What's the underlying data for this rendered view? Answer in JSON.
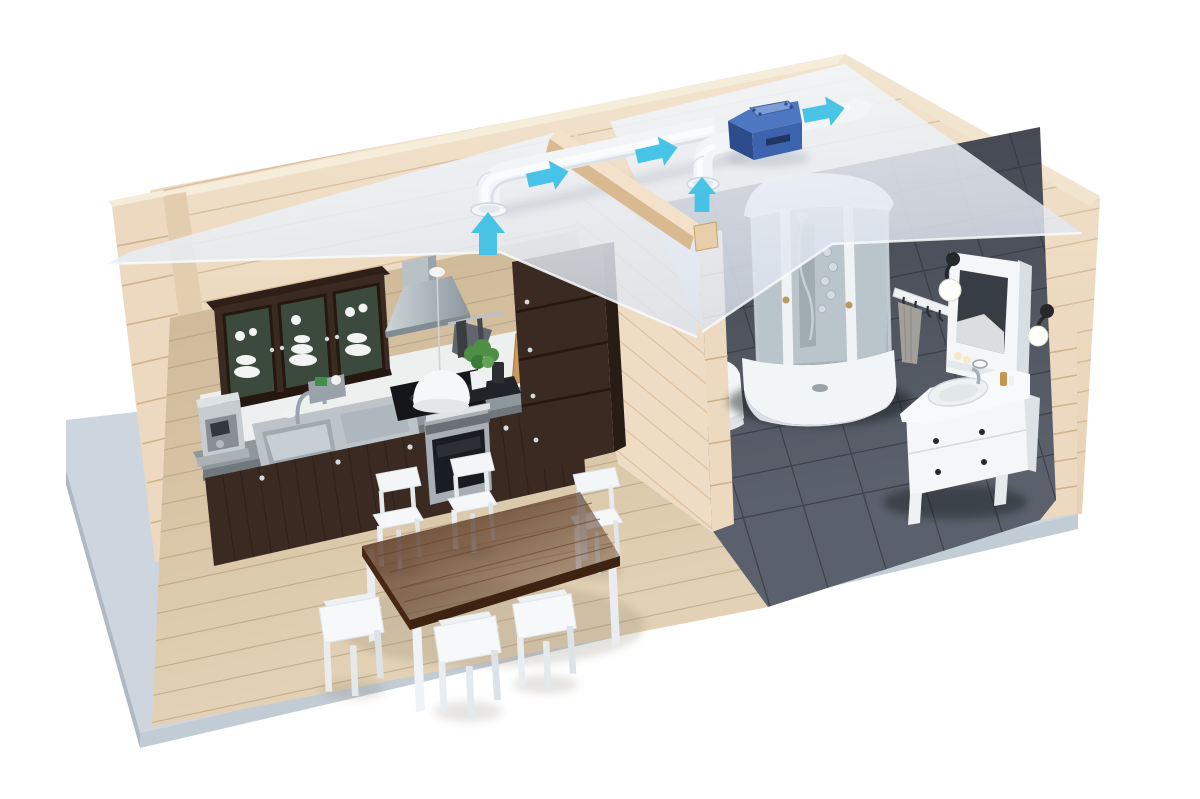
{
  "scene": {
    "title": "Home ventilation system 3D cutaway",
    "description": "Photorealistic 3D cutaway of a log-walled house interior showing a kitchen-dining room and a bathroom. A white ventilation duct runs above the translucent ceiling with two room intakes, an inline blue fan unit, and an exhaust through the wall; cyan arrows indicate the airflow direction upward from the rooms and outward along the duct.",
    "rooms": [
      {
        "name": "kitchen-dining",
        "floor": "light wood planks"
      },
      {
        "name": "bathroom",
        "floor": "dark gray tiles"
      }
    ],
    "ventilation": {
      "intake_count": 2,
      "fan_unit_count": 1,
      "airflow_arrow_count": 5,
      "airflow_direction": "up from rooms, right along duct, out through wall"
    },
    "objects": [
      "log-walls",
      "partition-wall",
      "translucent-ceiling",
      "gray-base-platform",
      "wall-cabinet-with-dishes",
      "range-hood",
      "pendant-lamp",
      "induction-cooktop",
      "built-in-oven",
      "kitchen-sink",
      "faucet",
      "coffee-machine",
      "sponge-holder",
      "utensil-rail",
      "cutting-boards",
      "potted-plant",
      "tall-pantry-cabinet",
      "base-cabinets",
      "dining-table",
      "white-chairs-x6",
      "corner-shower-cabin",
      "toilet-partially-hidden",
      "towel-hook-rack",
      "gray-towel",
      "mirror-cabinet",
      "wall-sconce-left",
      "wall-sconce-right",
      "vanity-with-sink"
    ]
  },
  "palette": {
    "bg": "#ffffff",
    "wall_wood": "#eedcc5",
    "wall_top": "#f6ecda",
    "log_end": "#ecd9bf",
    "floor_wood": "#d8c4a6",
    "tile_floor": "#474c56",
    "platform": "#cdd6de",
    "cabinet_dark": "#3a2a21",
    "counter": "#8e979c",
    "steel": "#c2c9ce",
    "white_furniture": "#f4f6f8",
    "table_top": "#54311d",
    "duct_white": "#f2f5f8",
    "fan_blue": "#3b63ae",
    "fan_blue_dark": "#2c4c8c",
    "fan_blue_light": "#7e9dd6",
    "arrow_cyan": "#3fc1e6",
    "towel_gray": "#a39f9a",
    "plant_green": "#4e8f45",
    "sconce_black": "#26282b"
  }
}
